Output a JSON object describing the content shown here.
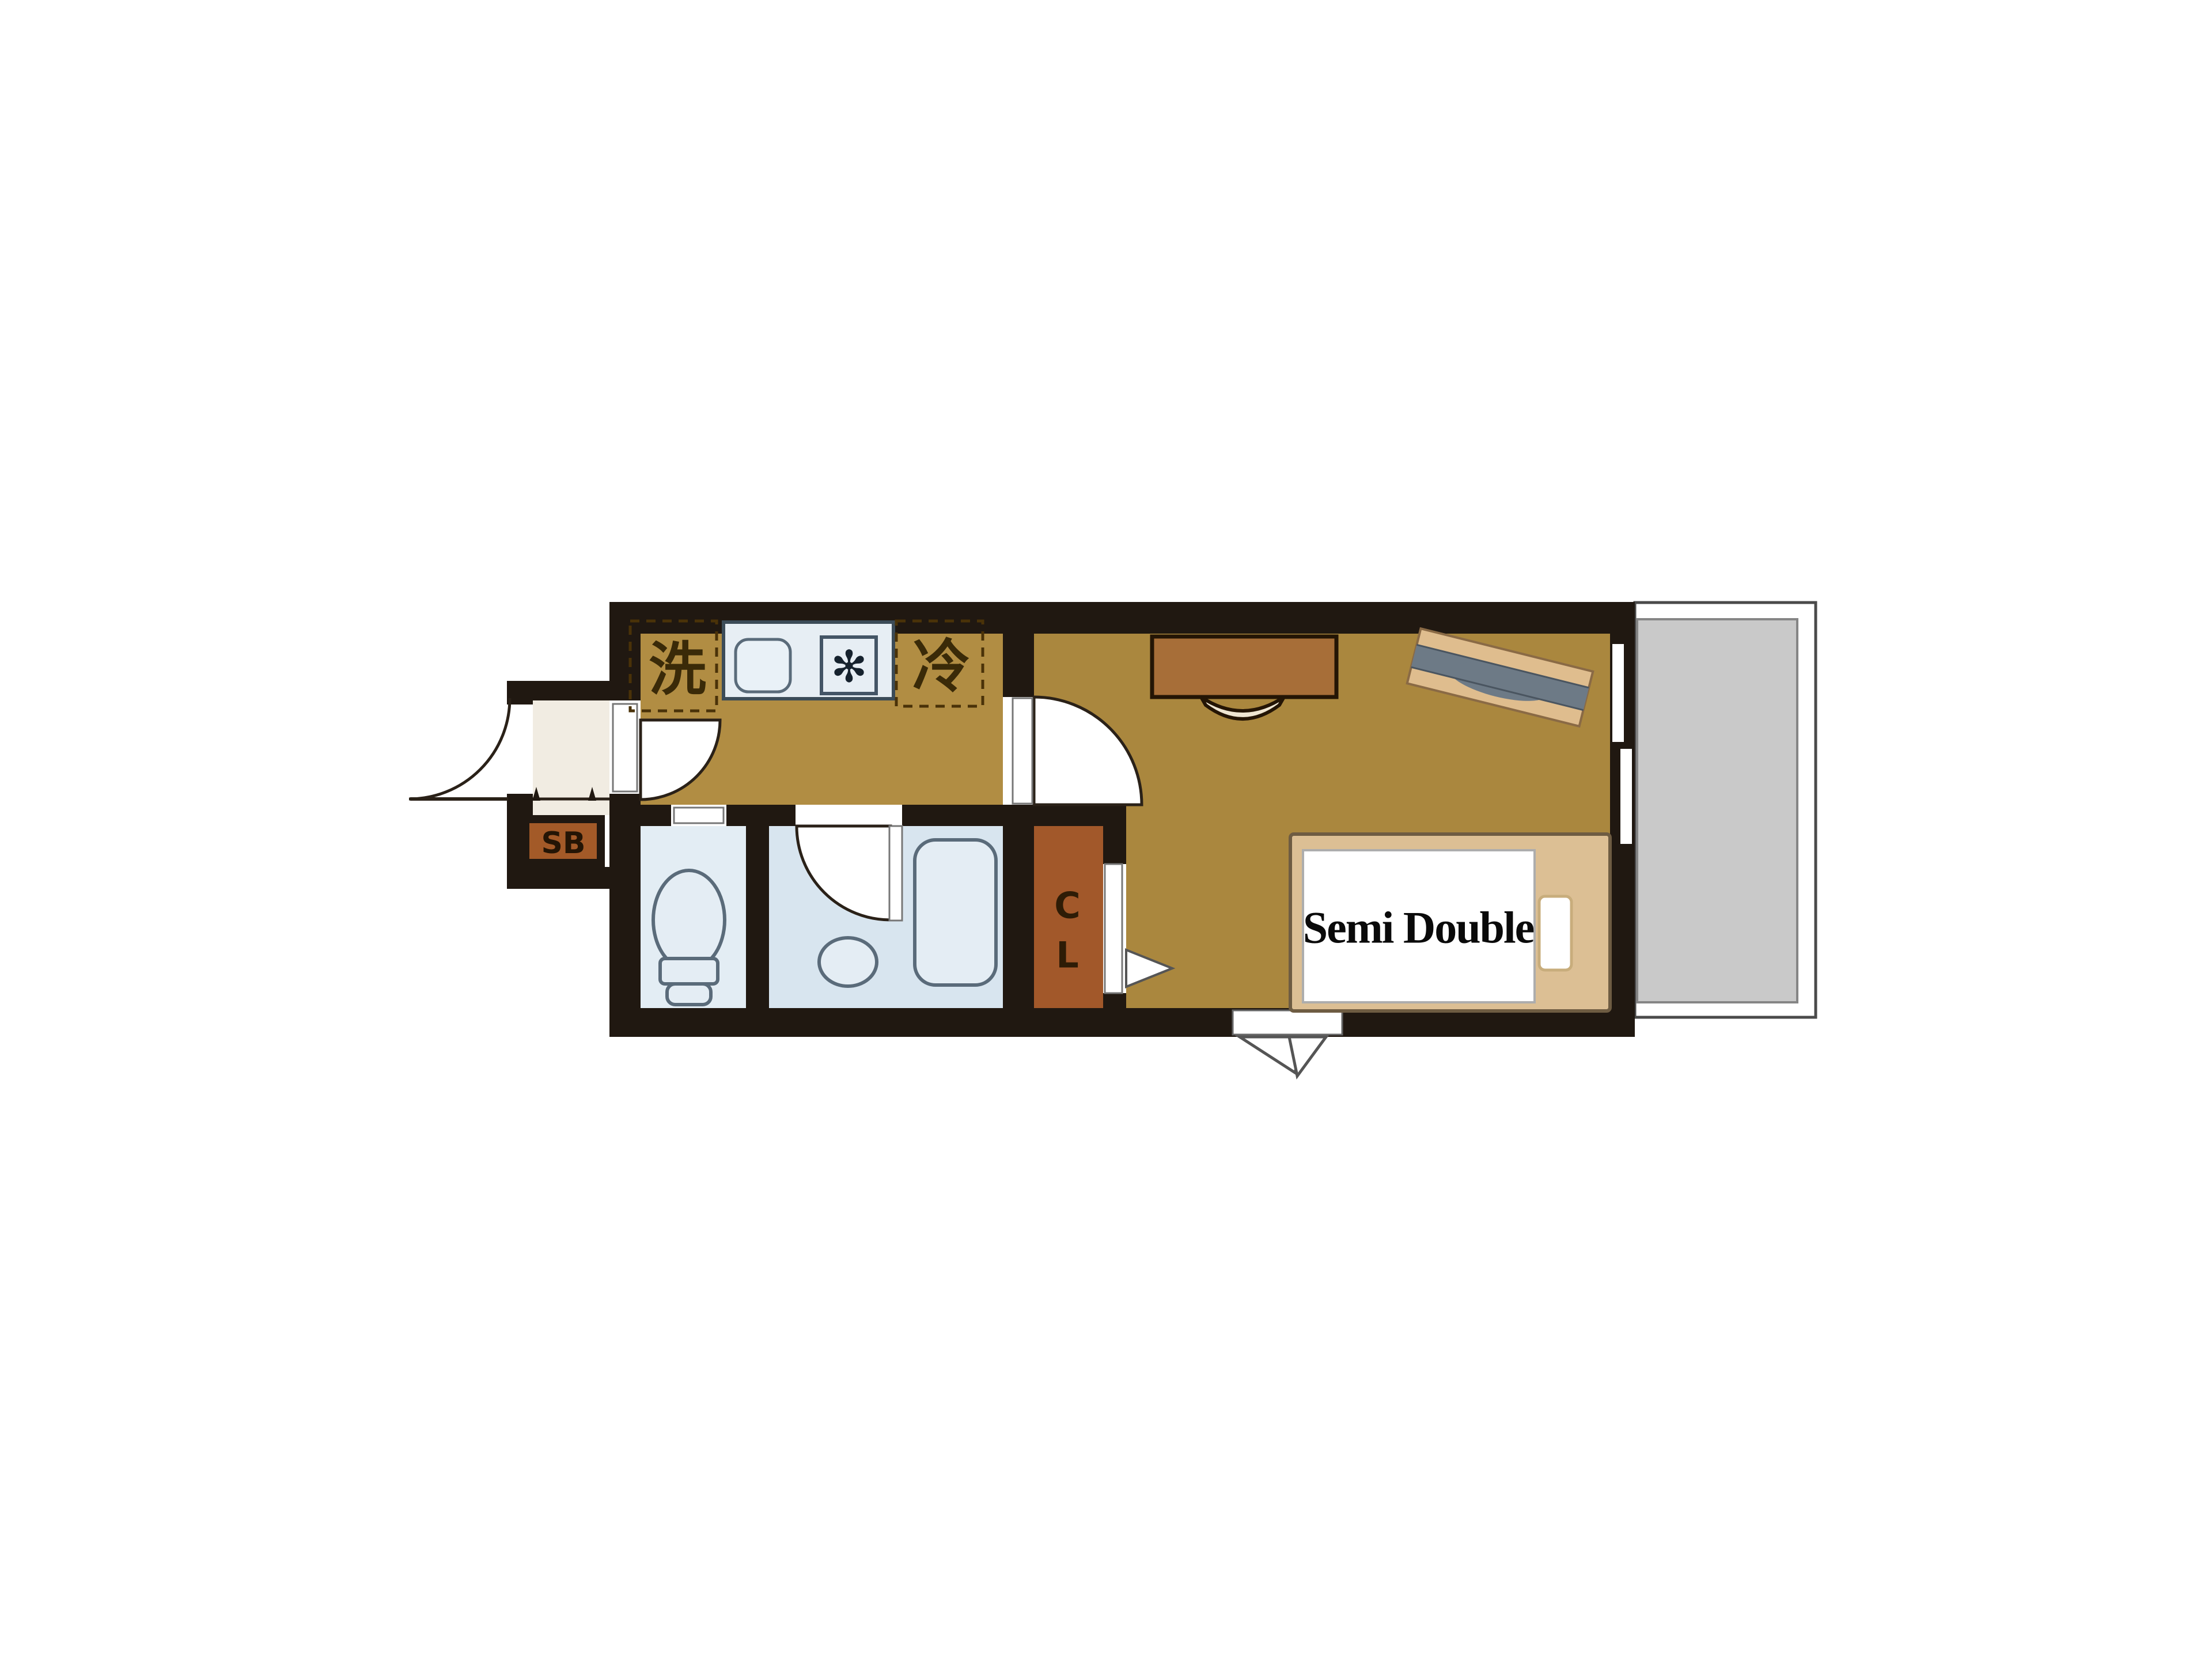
{
  "floorplan": {
    "labels": {
      "washer": "洗",
      "fridge": "冷",
      "stove_symbol": "✻",
      "shoe_box": "SB",
      "closet_line1": "C",
      "closet_line2": "L",
      "bed": "Semi Double"
    },
    "colors": {
      "wall": "#201811",
      "floor_kitchen": "#b18d43",
      "floor_main": "#aa873e",
      "floor_toilet": "#e3edf4",
      "floor_bath": "#d8e5ef",
      "closet_brown": "#a2582a",
      "shoebox_brown": "#a35a28",
      "genkan_cream": "#f1ece2",
      "counter_blue": "#e7eef4",
      "desk_brown": "#a76e38",
      "board_tan": "#dfbd8e",
      "board_gray": "#6d7a86",
      "bed_frame_tan": "#dcbf94",
      "mattress_white": "#ffffff",
      "balcony_gray": "#c9c9c9",
      "label_dark": "#3a2a08",
      "bed_text": "#0a0a0a",
      "chair_cream": "#efe6d2"
    }
  }
}
